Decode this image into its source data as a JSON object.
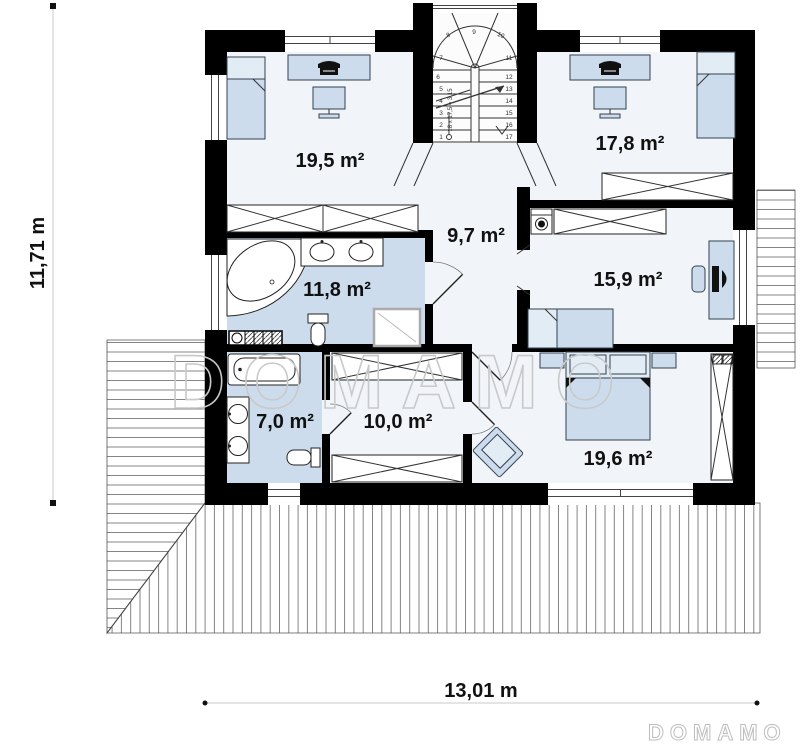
{
  "plan_type": "floor-plan",
  "watermark": "DOMAMO",
  "brand_logo": "DOMAMO",
  "dimensions": {
    "vertical": "11,71 m",
    "horizontal": "13,01 m"
  },
  "rooms": {
    "bedroom_top_left": "19,5 m²",
    "bedroom_top_right": "17,8 m²",
    "hall": "9,7 m²",
    "bathroom_main": "11,8 m²",
    "bedroom_right": "15,9 m²",
    "bathroom_small": "7,0 m²",
    "wardrobe_room": "10,0 m²",
    "bedroom_master": "19,6 m²"
  },
  "stairs": {
    "annotation": "18 x 17,5 = 3,15",
    "steps": [
      "1",
      "2",
      "3",
      "4",
      "5",
      "6",
      "7",
      "8",
      "9",
      "10",
      "11",
      "12",
      "13",
      "14",
      "15",
      "16",
      "17"
    ]
  },
  "colors": {
    "wall": "#000000",
    "furniture_fill": "#ccdcec",
    "bathroom_floor": "#ccdcec",
    "room_floor": "#f1f5f9",
    "watermark": "#c9c9c9",
    "deck_line": "#666666"
  }
}
